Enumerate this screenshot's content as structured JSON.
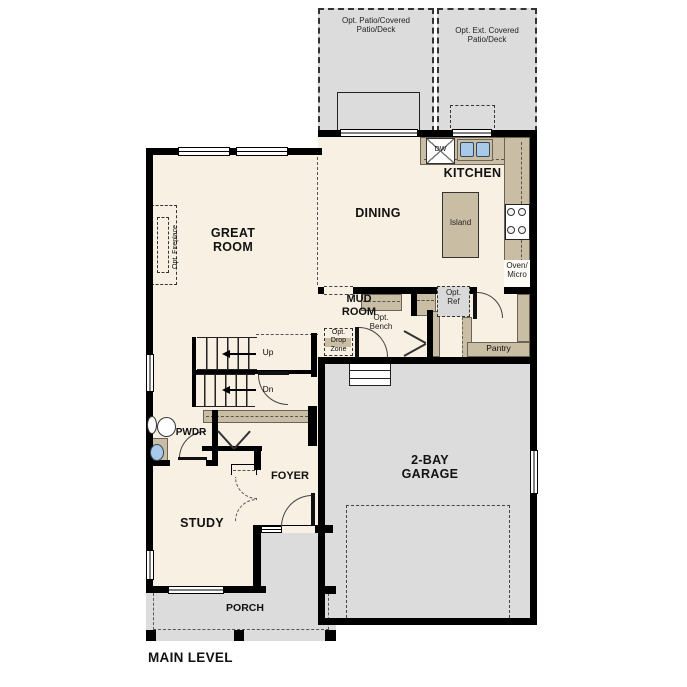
{
  "plan": {
    "title": "MAIN LEVEL",
    "rooms": {
      "kitchen": "KITCHEN",
      "dining": "DINING",
      "great_room": "GREAT\nROOM",
      "mud_room": "MUD\nROOM",
      "pantry": "Pantry",
      "pwdr": "PWDR",
      "foyer": "FOYER",
      "study": "STUDY",
      "garage": "2-BAY\nGARAGE",
      "porch": "PORCH"
    },
    "outdoor": {
      "patio_left": "Opt. Patio/Covered\nPatio/Deck",
      "patio_right": "Opt. Ext. Covered\nPatio/Deck"
    },
    "fixtures": {
      "island": "Island",
      "dishwasher": "DW",
      "oven_micro": "Oven/\nMicro",
      "opt_bench": "Opt.\nBench",
      "opt_drop_zone": "Opt.\nDrop\nZone",
      "opt_ref": "Opt.\nRef",
      "opt_fireplace": "Opt. Fireplace"
    },
    "stairs": {
      "up": "Up",
      "dn": "Dn"
    },
    "colors": {
      "floor": "#f7f0e3",
      "counter": "#c9bda3",
      "concrete": "#dcdcdc",
      "wall": "#000000",
      "sink": "#a9c9e9"
    }
  }
}
